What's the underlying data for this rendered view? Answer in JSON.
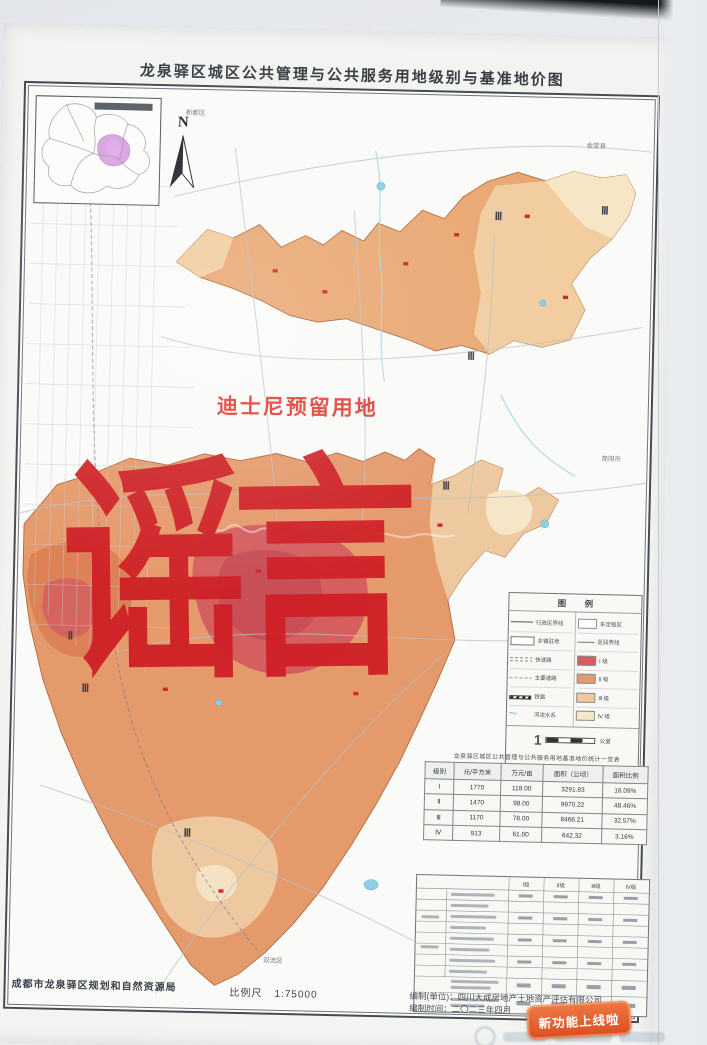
{
  "photo": {
    "badge_label": "新功能上线啦"
  },
  "sheet": {
    "title": "龙泉驿区城区公共管理与公共服务用地级别与基准地价图",
    "annotation_disney": "迪士尼预留用地",
    "watermark_rumor": "谣言",
    "north_label": "N",
    "footer": {
      "agency": "成都市龙泉驿区规划和自然资源局",
      "scale_label": "比例尺",
      "scale_value": "1:75000",
      "maker_line": "编制(单位)：四川大成房地产土地资产评估有限公司",
      "date_line": "编制时间：二〇二三年四月"
    }
  },
  "map": {
    "grade_labels": {
      "g2": "Ⅱ",
      "g3": "Ⅲ"
    },
    "edge_labels": [
      "新都区",
      "金堂县",
      "简阳市",
      "双流区"
    ]
  },
  "legend": {
    "title": "图  例",
    "left": [
      {
        "label": "行政区界线"
      },
      {
        "label": "乡镇驻地"
      },
      {
        "label": "快速路"
      },
      {
        "label": "主要道路"
      },
      {
        "label": "铁路"
      },
      {
        "label": "河流水系"
      }
    ],
    "right": [
      {
        "label": "未定级区"
      },
      {
        "label": "区段界线"
      },
      {
        "label": "Ⅰ 级"
      },
      {
        "label": "Ⅱ 级"
      },
      {
        "label": "Ⅲ 级"
      },
      {
        "label": "Ⅳ 级"
      }
    ],
    "scale_mark": "1",
    "scale_unit": "公里"
  },
  "price_table": {
    "title": "龙泉驿区城区公共管理与公共服务用地基准地价统计一览表",
    "headers": [
      "级别",
      "元/平方米",
      "万元/亩",
      "面积（公顷）",
      "面积比例"
    ],
    "rows": [
      [
        "Ⅰ",
        "1770",
        "118.00",
        "3291.83",
        "16.09%"
      ],
      [
        "Ⅱ",
        "1470",
        "98.00",
        "9970.22",
        "48.46%"
      ],
      [
        "Ⅲ",
        "1170",
        "78.00",
        "8466.21",
        "32.57%"
      ],
      [
        "Ⅳ",
        "913",
        "61.00",
        "642.32",
        "3.16%"
      ]
    ]
  },
  "factor_table": {
    "level_headers": [
      "Ⅰ级",
      "Ⅱ级",
      "Ⅲ级",
      "Ⅳ级"
    ]
  },
  "colors": {
    "grade1": "#d55f5f",
    "grade2": "#e59a6c",
    "grade3": "#eec9a0",
    "grade4": "#f6e6c8",
    "water": "#8ecfe4",
    "rumor_red": "#cf2127",
    "badge_orange": "#d94e20"
  }
}
